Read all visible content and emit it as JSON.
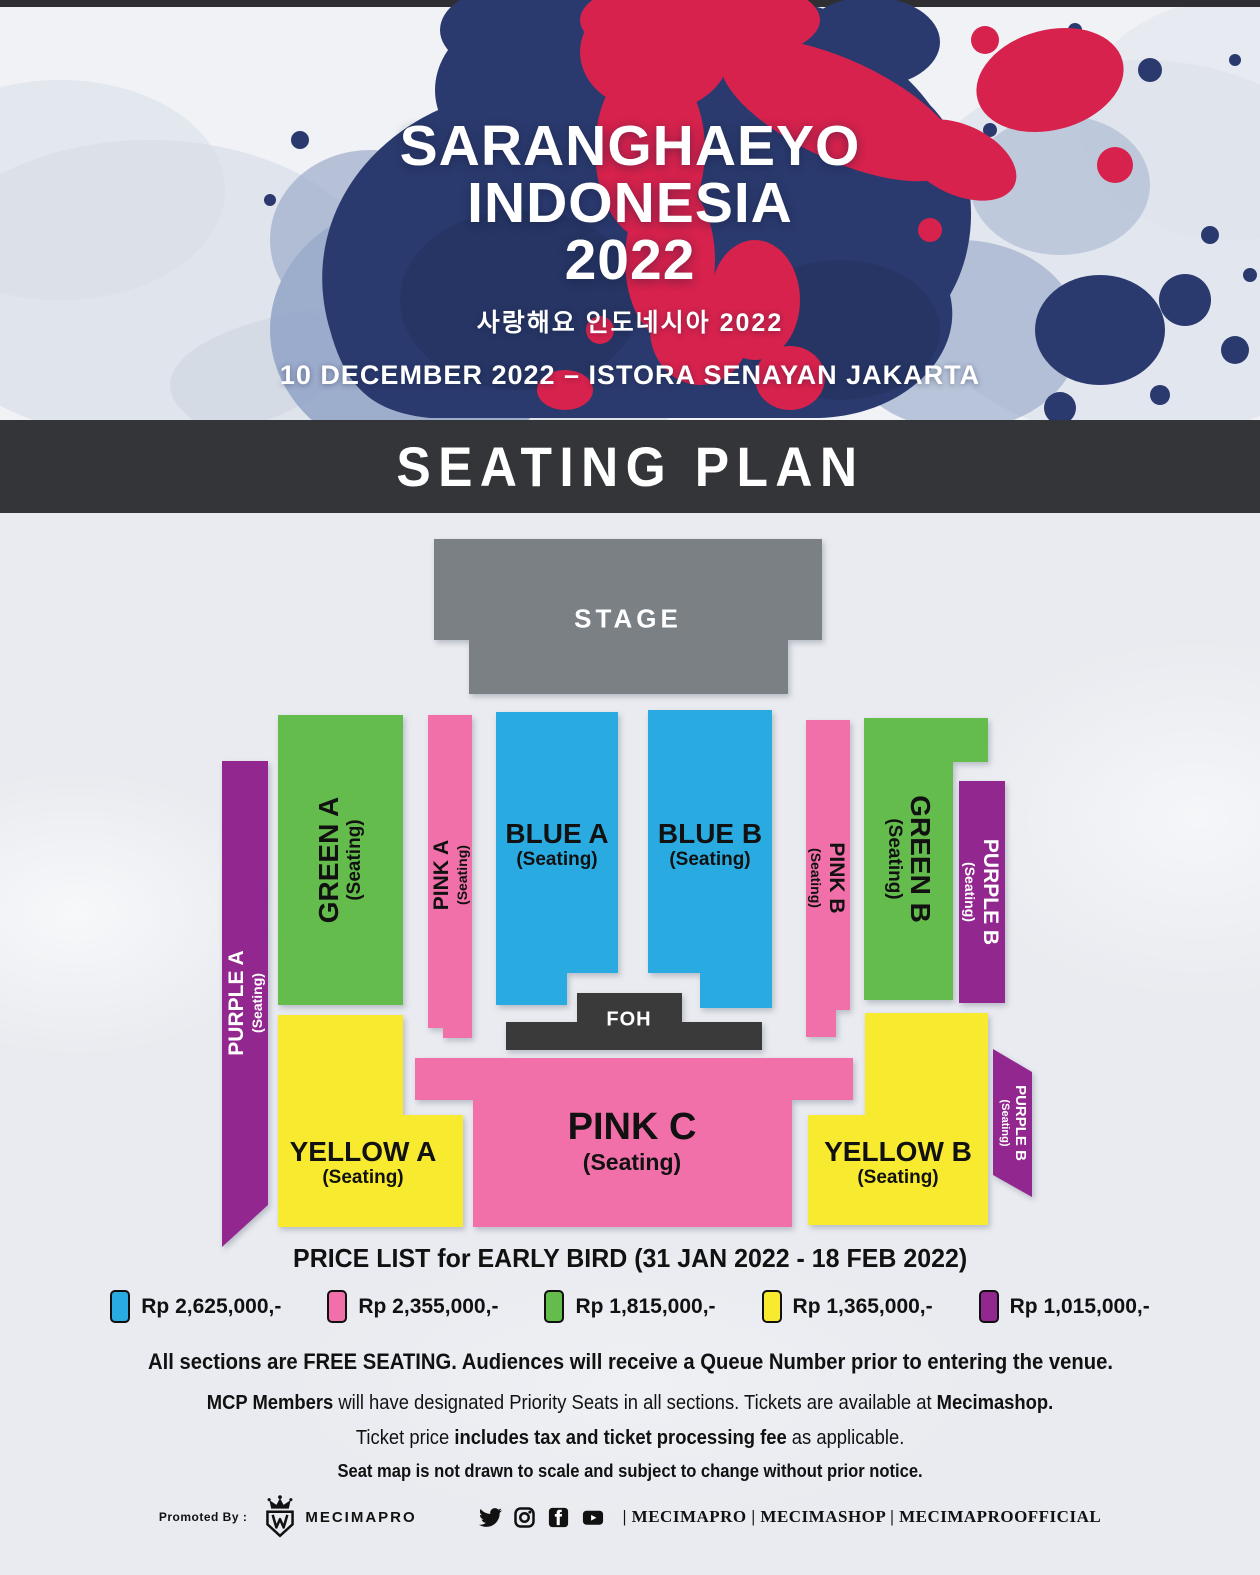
{
  "header": {
    "title_line1": "SARANGHAEYO",
    "title_line2": "INDONESIA",
    "title_line3": "2022",
    "subtitle_korean": "사랑해요 인도네시아 2022",
    "event_info": "10 DECEMBER 2022 – ISTORA SENAYAN JAKARTA",
    "colors": {
      "navy": "#2b3a6e",
      "navy_dark": "#223059",
      "red": "#d6224c",
      "steel": "#8c9fc4",
      "wash": "#ccd3e0"
    }
  },
  "banner": {
    "label": "SEATING PLAN",
    "bg": "#333538"
  },
  "seating_map": {
    "stage": {
      "label": "STAGE",
      "color": "#7b8084"
    },
    "foh": {
      "label": "FOH",
      "color": "#3a3a3a"
    },
    "sections": [
      {
        "id": "green-a",
        "name": "GREEN A",
        "sub": "(Seating)",
        "color": "#64bc4c"
      },
      {
        "id": "pink-a",
        "name": "PINK A",
        "sub": "(Seating)",
        "color": "#f170a9"
      },
      {
        "id": "blue-a",
        "name": "BLUE A",
        "sub": "(Seating)",
        "color": "#29abe2"
      },
      {
        "id": "blue-b",
        "name": "BLUE B",
        "sub": "(Seating)",
        "color": "#29abe2"
      },
      {
        "id": "pink-b",
        "name": "PINK B",
        "sub": "(Seating)",
        "color": "#f170a9"
      },
      {
        "id": "green-b",
        "name": "GREEN B",
        "sub": "(Seating)",
        "color": "#64bc4c"
      },
      {
        "id": "purple-b-upper",
        "name": "PURPLE B",
        "sub": "(Seating)",
        "color": "#92278f"
      },
      {
        "id": "purple-a",
        "name": "PURPLE A",
        "sub": "(Seating)",
        "color": "#92278f"
      },
      {
        "id": "yellow-a",
        "name": "YELLOW A",
        "sub": "(Seating)",
        "color": "#f8eb2f"
      },
      {
        "id": "pink-c",
        "name": "PINK C",
        "sub": "(Seating)",
        "color": "#f170a9"
      },
      {
        "id": "yellow-b",
        "name": "YELLOW B",
        "sub": "(Seating)",
        "color": "#f8eb2f"
      },
      {
        "id": "purple-b-lower",
        "name": "PURPLE B",
        "sub": "(Seating)",
        "color": "#92278f"
      }
    ]
  },
  "price_list": {
    "title": "PRICE LIST for EARLY BIRD (31 JAN 2022 - 18 FEB 2022)",
    "items": [
      {
        "section_color": "#29abe2",
        "label": "Rp 2,625,000,-"
      },
      {
        "section_color": "#f170a9",
        "label": "Rp 2,355,000,-"
      },
      {
        "section_color": "#64bc4c",
        "label": "Rp 1,815,000,-"
      },
      {
        "section_color": "#f8eb2f",
        "label": "Rp 1,365,000,-"
      },
      {
        "section_color": "#92278f",
        "label": "Rp 1,015,000,-"
      }
    ]
  },
  "notes": {
    "free_seating": "All sections are FREE SEATING. Audiences will receive a Queue Number prior to entering the venue.",
    "mcp_bold_lead": "MCP Members",
    "mcp_middle": " will have designated Priority Seats in all sections.  Tickets are available at ",
    "mcp_bold_tail": "Mecimashop.",
    "tax_lead": "Ticket price ",
    "tax_bold": "includes tax and ticket processing fee",
    "tax_tail": " as applicable.",
    "disclaimer": "Seat map is not drawn to scale and subject to change without prior notice."
  },
  "footer": {
    "promoted_by": "Promoted By :",
    "logo_text": "MECIMAPRO",
    "social_icons": [
      "twitter-icon",
      "instagram-icon",
      "facebook-icon",
      "youtube-icon"
    ],
    "handles": "| MECIMAPRO | MECIMASHOP | MECIMAPROOFFICIAL"
  }
}
